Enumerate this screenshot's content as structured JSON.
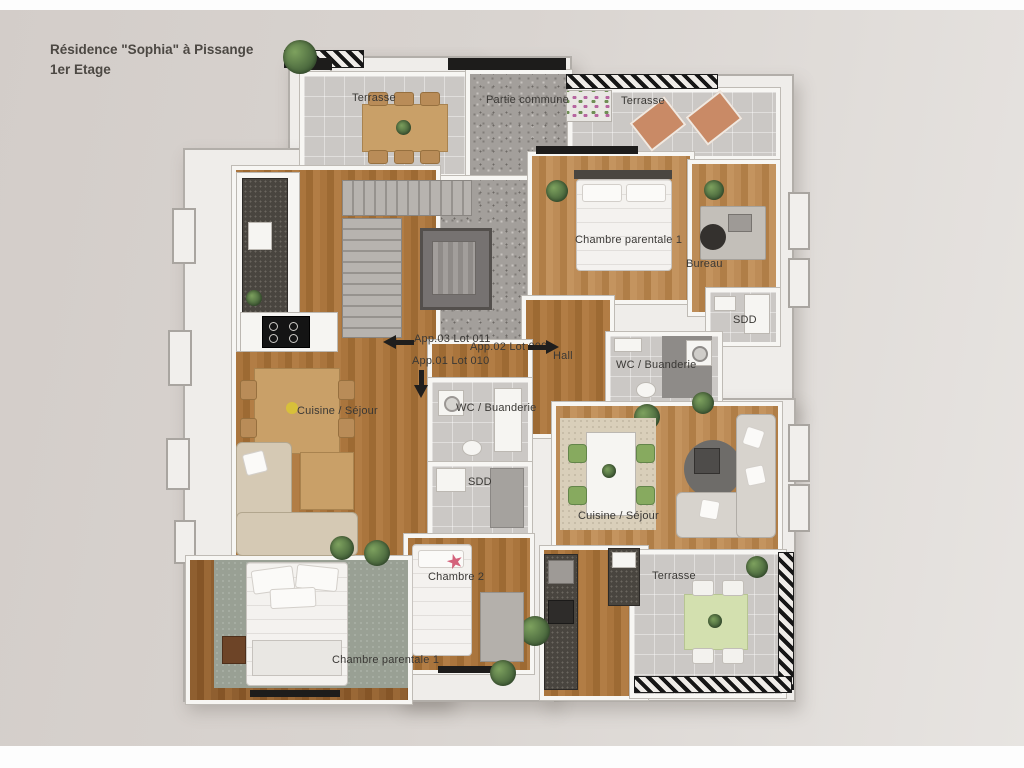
{
  "title": {
    "line1": "Résidence \"Sophia\" à Pissange",
    "line2": "1er Etage"
  },
  "labels": {
    "terrasse_nw": "Terrasse",
    "partie_commune": "Partie commune",
    "terrasse_ne": "Terrasse",
    "chambre_parentale_right": "Chambre parentale 1",
    "bureau": "Bureau",
    "sdd_right": "SDD",
    "wc_buanderie_right": "WC / Buanderie",
    "hall": "Hall",
    "app03": "App.03 Lot 011",
    "app02": "App.02 Lot 009",
    "app01": "App.01 Lot 010",
    "wc_buanderie_left": "WC / Buanderie",
    "sdd_center": "SDD",
    "cuisine_sejour_left": "Cuisine / Séjour",
    "cuisine_sejour_right": "Cuisine / Séjour",
    "chambre_2": "Chambre 2",
    "chambre_parentale_left": "Chambre parentale 1",
    "terrasse_se": "Terrasse"
  },
  "colors": {
    "background": "#d9d4d0",
    "wall_white": "#f7f6f3",
    "wood_floor_light": "#b98a52",
    "wood_floor_dark": "#8f5f30",
    "tile_gray": "#cbc8c5",
    "terrazzo_gray": "#a39f9b",
    "railing_black": "#161616",
    "label_text": "#3a3835",
    "accent_green_chair": "#87aa5f",
    "accent_terracotta": "#c98a66",
    "accent_star_pink": "#d4627b"
  },
  "icons": {
    "arrow_left": "left-arrow",
    "arrow_right": "right-arrow",
    "arrow_down": "down-arrow"
  }
}
